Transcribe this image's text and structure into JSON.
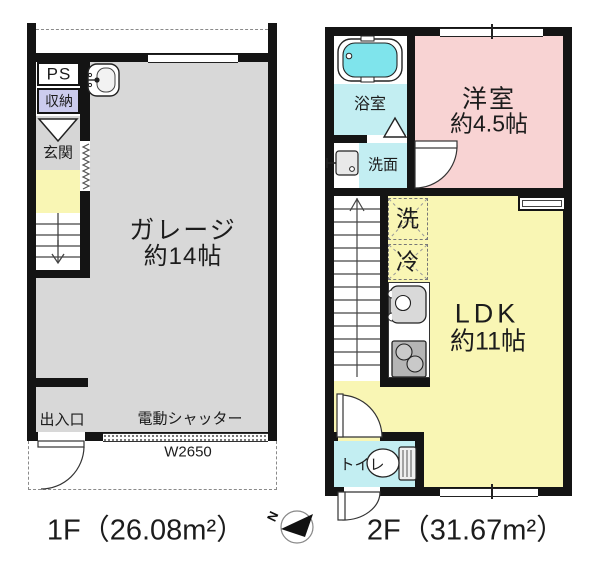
{
  "colors": {
    "wall": "#141414",
    "garage_gray": "#d8d8d8",
    "room_yellow": "#f9f6b4",
    "room_pink": "#f8d3d3",
    "room_cyan": "#c3eef2",
    "bathtub_cyan": "#7fe4ec",
    "storage_lavender": "#ccccee"
  },
  "floor1": {
    "title": "1F（26.08m²）",
    "garage_name": "ガレージ",
    "garage_size": "約14帖",
    "pipe_space": "PS",
    "storage": "収納",
    "entrance": "玄関",
    "doorway": "出入口",
    "electric_shutter": "電動シャッター",
    "shutter_width": "W2650"
  },
  "floor2": {
    "title": "2F（31.67m²）",
    "bathroom": "浴室",
    "washroom": "洗面",
    "western_room_name": "洋室",
    "western_room_size": "約4.5帖",
    "ldk_name": "LDK",
    "ldk_size": "約11帖",
    "toilet": "トイレ",
    "washer": "洗",
    "refrigerator": "冷"
  },
  "compass": {
    "north_label": "N"
  },
  "icons": {
    "bathtub": "rounded-rect-tub",
    "utility_sink": "basin-with-faucet",
    "washroom_sink": "basin-with-faucet",
    "kitchen_sink": "basin-round-bowl",
    "stove": "two-burner-cooktop",
    "toilet": "bowl-and-tank",
    "stairs_up": "↑",
    "stairs_down": "↓",
    "door_swing": "quarter-arc",
    "accordion_door": "zigzag",
    "compass_north": "◀ + N"
  }
}
